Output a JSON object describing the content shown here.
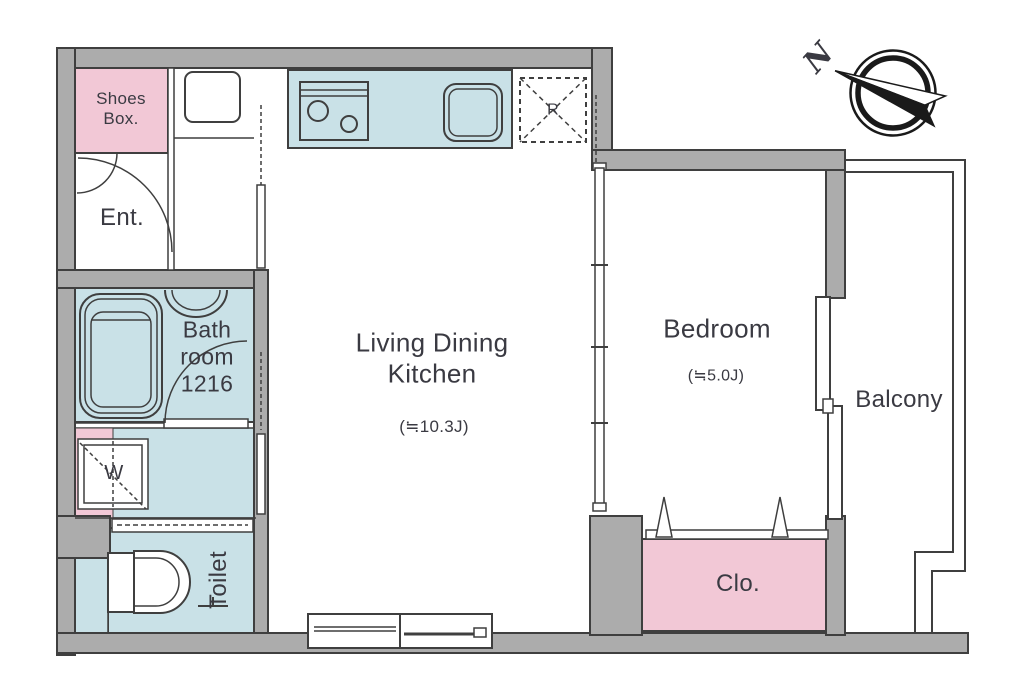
{
  "colors": {
    "wall": "#acacac",
    "outline": "#3f3f3f",
    "pink": "#f2c8d6",
    "blue": "#c9e1e7",
    "text": "#3a3a42",
    "needle": "#1a1a1a"
  },
  "rooms": {
    "shoes_box": {
      "label": "Shoes\nBox."
    },
    "entrance": {
      "label": "Ent."
    },
    "bathroom": {
      "label": "Bath\nroom\n1216"
    },
    "washer": {
      "label": "W"
    },
    "toilet": {
      "label": "Toilet"
    },
    "ldk": {
      "label": "Living Dining\nKitchen",
      "size": "(≒10.3J)"
    },
    "bedroom": {
      "label": "Bedroom",
      "size": "(≒5.0J)"
    },
    "balcony": {
      "label": "Balcony"
    },
    "closet": {
      "label": "Clo."
    },
    "refrigerator": {
      "label": "R"
    }
  },
  "compass": {
    "north_label": "N"
  }
}
